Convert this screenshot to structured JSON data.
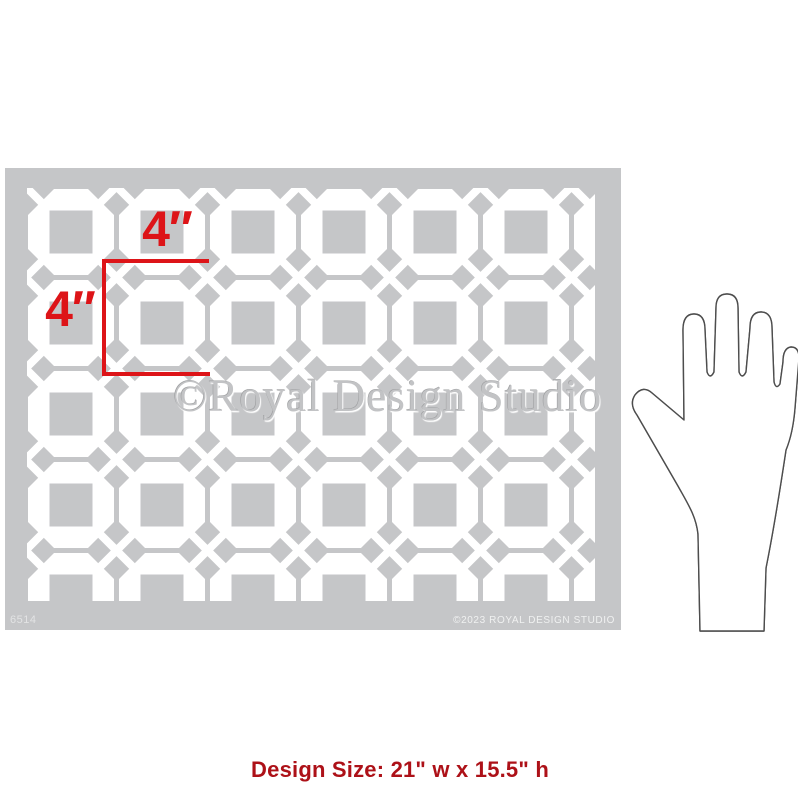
{
  "stencil": {
    "sku": "6514",
    "watermark": "©Royal Design Studio",
    "copyright": "©2023 ROYAL DESIGN STUDIO",
    "sheet_color": "#c5c6c8",
    "cutout_color": "#ffffff",
    "tile_grid": {
      "columns": 7,
      "rows": 5,
      "motif": "octagon with square center and corner cross"
    },
    "marker": {
      "width_label": "4″",
      "height_label": "4″",
      "color": "#dd1418"
    }
  },
  "scale_reference": {
    "type": "hand illustration",
    "nail_color": "#db5191",
    "outline_color": "#4d4d4d"
  },
  "caption": {
    "text": "Design Size: 21\" w x 15.5\" h",
    "color": "#ad1118"
  }
}
